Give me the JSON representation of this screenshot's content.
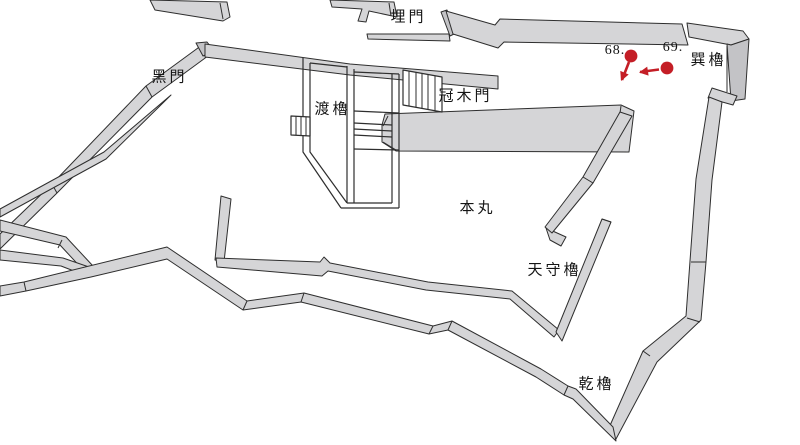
{
  "map": {
    "labels": {
      "uzumimon": "埋門",
      "kuromon": "黑門",
      "watari_yagura": "渡櫓",
      "kabuki_mon": "冠木門",
      "tatsumi_yagura": "巽櫓",
      "honmaru": "本丸",
      "tenshu_yagura": "天守櫓",
      "inui_yagura": "乾櫓"
    },
    "markers": [
      {
        "label": "68.",
        "dot": {
          "x": 631,
          "y": 56
        },
        "arrow_tip": {
          "x": 622,
          "y": 80
        }
      },
      {
        "label": "69.",
        "dot": {
          "x": 667,
          "y": 68
        },
        "arrow_tip": {
          "x": 640,
          "y": 72
        }
      }
    ]
  },
  "colors": {
    "accent_red": "#c41e26",
    "wall_fill": "#d5d5d7",
    "wall_shade": "#c3c3c6",
    "outline": "#2e2e2e",
    "background": "#ffffff"
  }
}
